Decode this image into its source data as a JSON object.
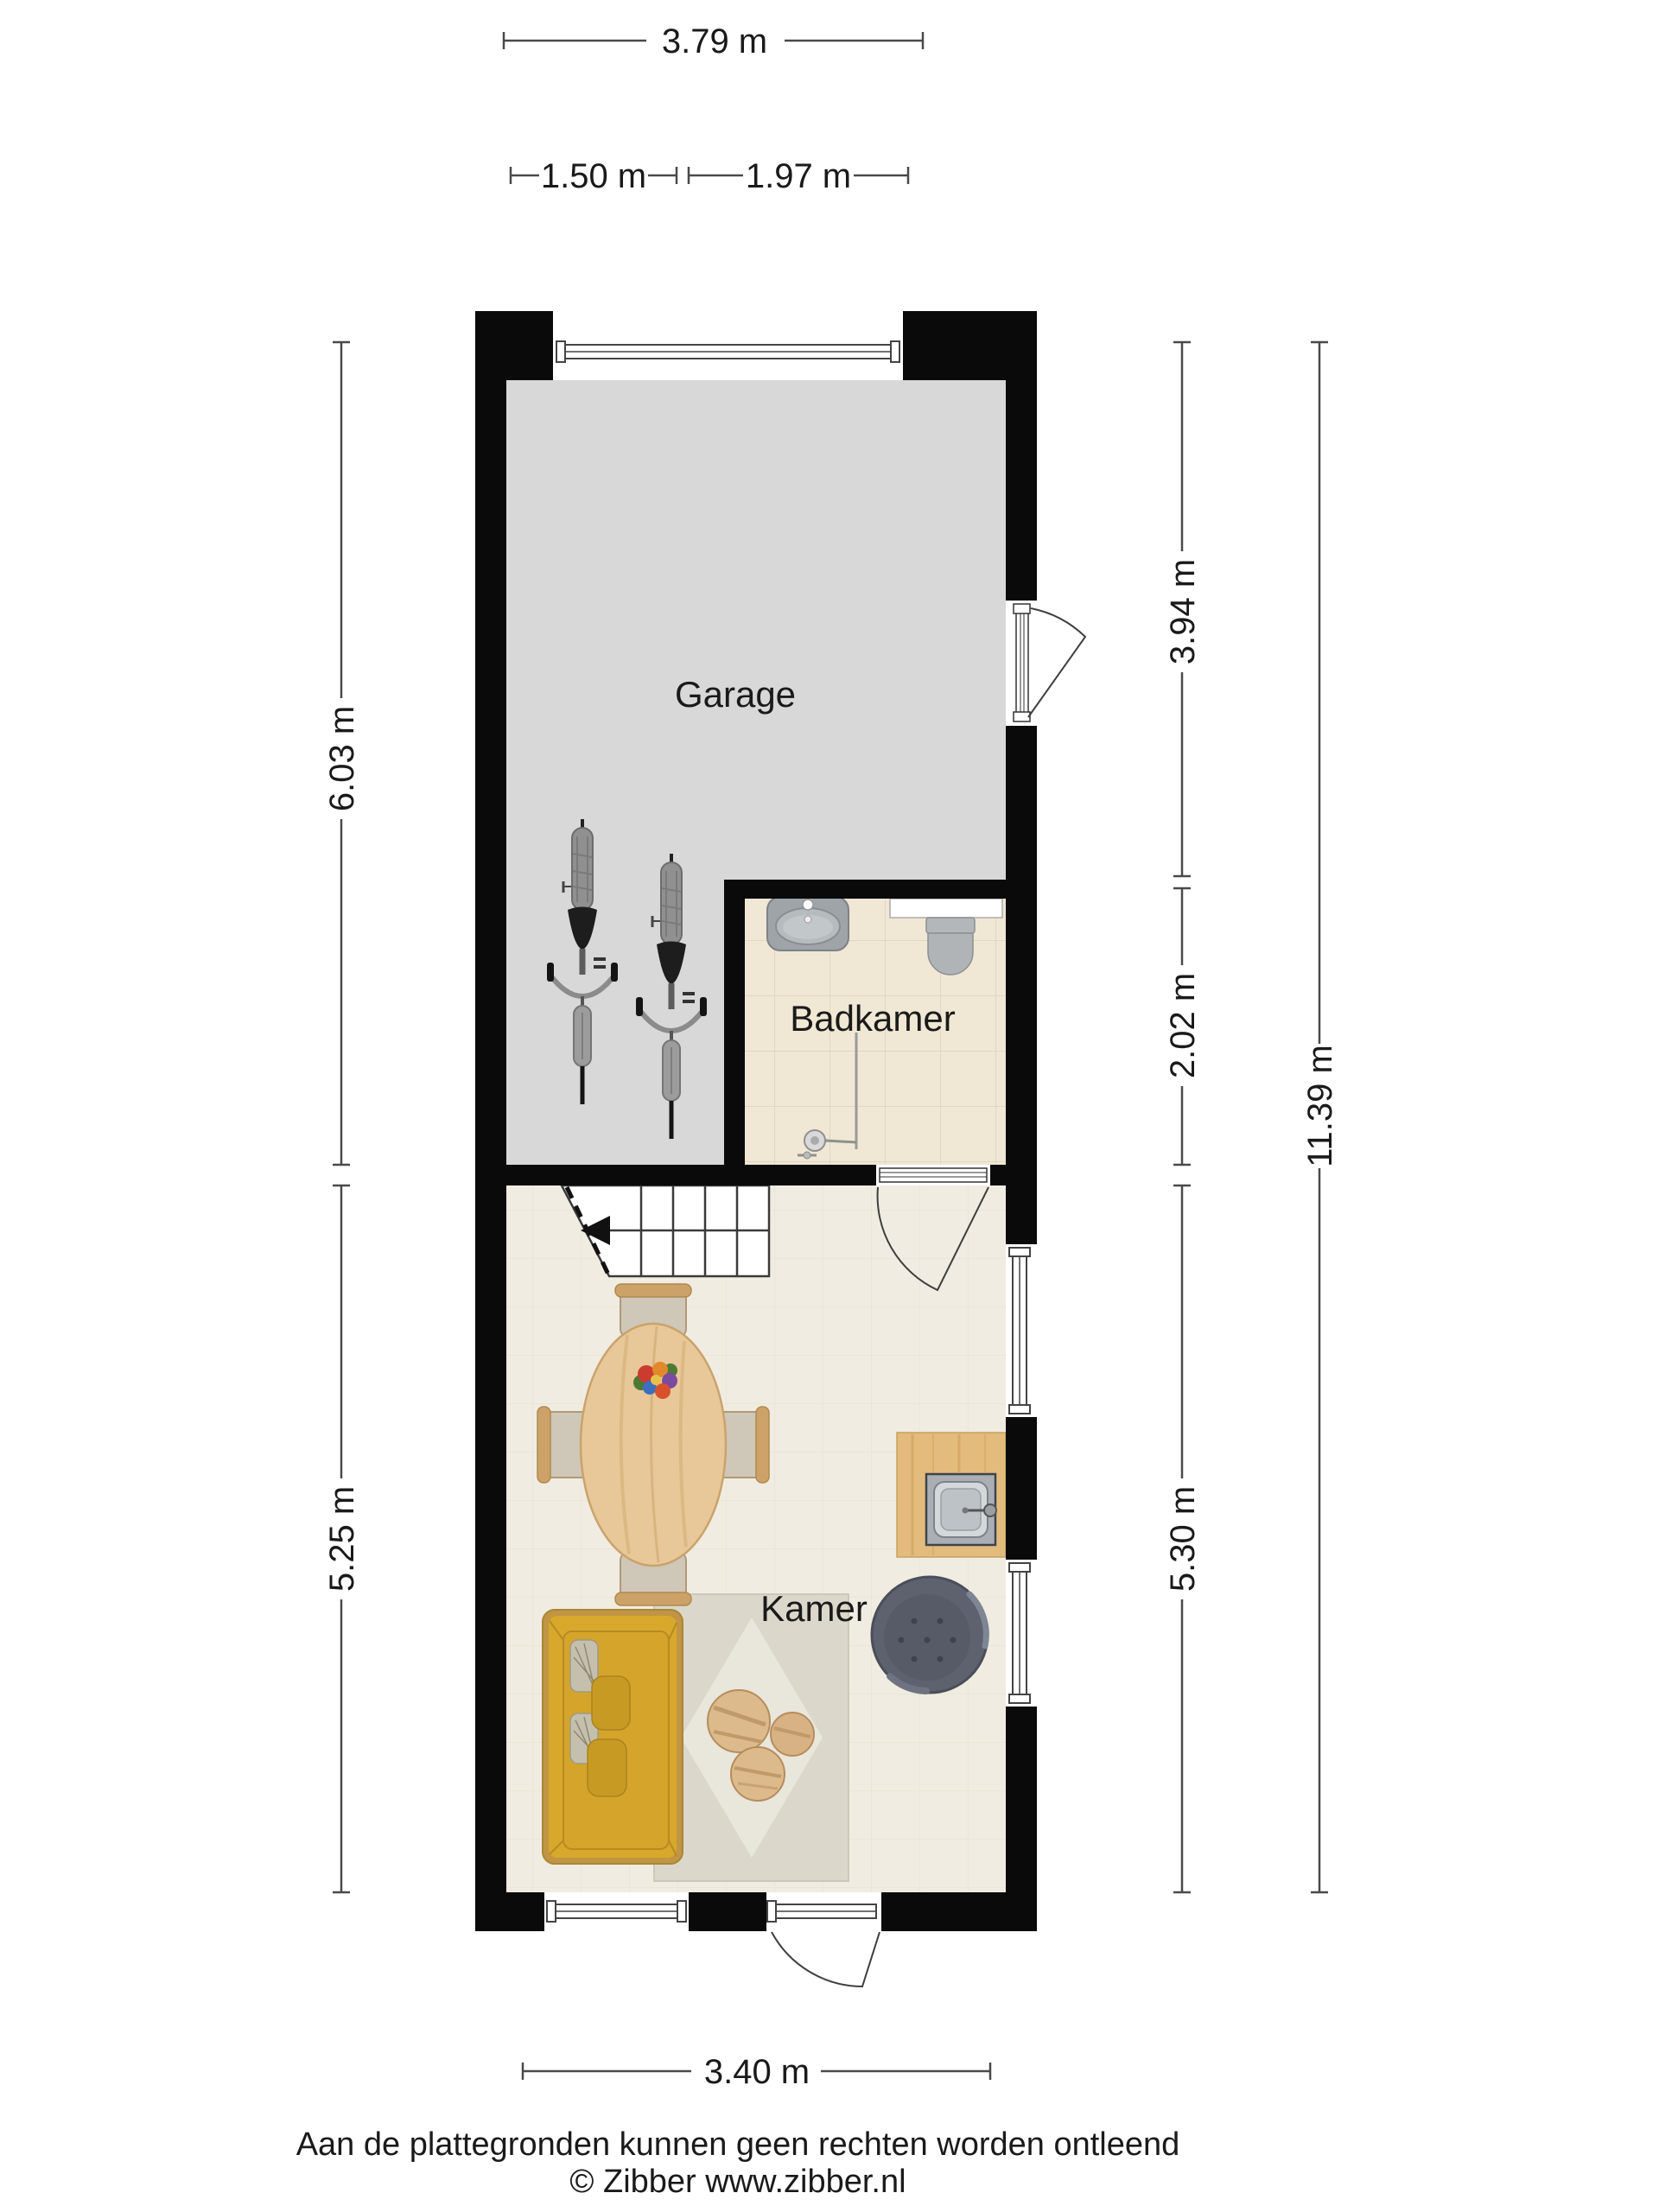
{
  "plan": {
    "rooms": {
      "garage": {
        "label": "Garage"
      },
      "badkamer": {
        "label": "Badkamer"
      },
      "kamer": {
        "label": "Kamer"
      }
    },
    "dimensions": {
      "top_width": "3.79 m",
      "top_left": "1.50 m",
      "top_right": "1.97 m",
      "left_upper": "6.03 m",
      "left_lower": "5.25 m",
      "right_upper": "3.94 m",
      "right_middle": "2.02 m",
      "right_lower": "5.30 m",
      "right_total": "11.39 m",
      "bottom_width": "3.40 m"
    }
  },
  "footer": {
    "line1": "Aan de plattegronden kunnen geen rechten worden ontleend",
    "line2": "© Zibber www.zibber.nl"
  },
  "colors": {
    "page_bg": "#ffffff",
    "wall": "#0a0a0a",
    "garage_floor": "#d8d8d8",
    "bath_floor": "#f0e7d4",
    "room_floor": "#f1ece1",
    "sofa": "#d8a82c",
    "counter": "#e3bb7d",
    "table_wood": "#e8c898",
    "armchair": "#5d626e",
    "rug": "#dbd8cb",
    "dim": "#4a4a4a",
    "text": "#1a1a1a"
  }
}
